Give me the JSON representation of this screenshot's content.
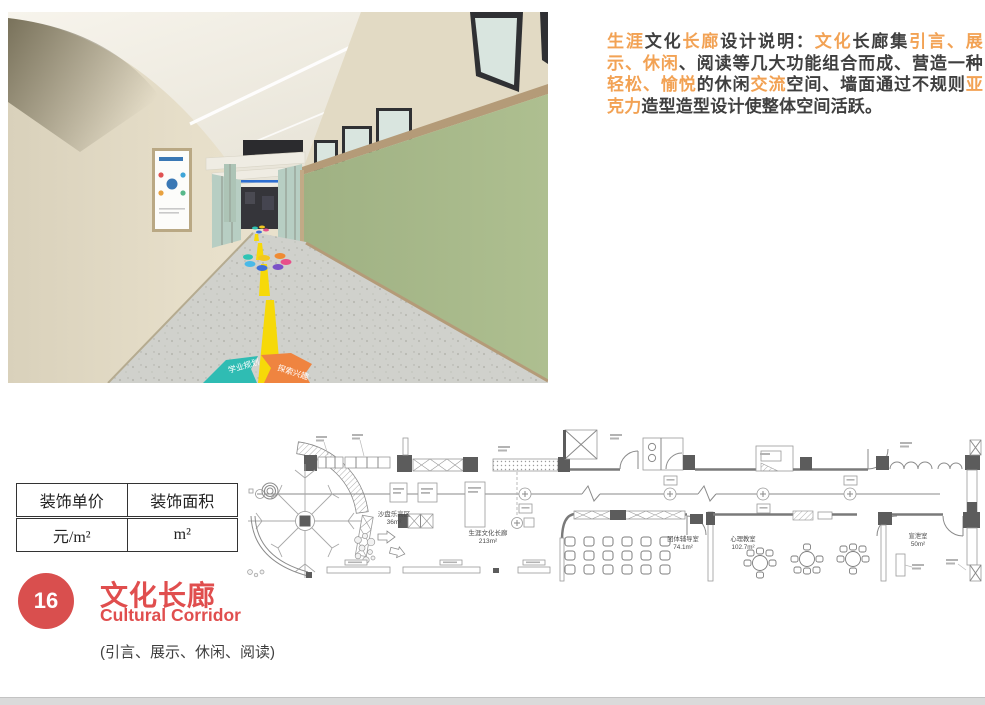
{
  "description": {
    "segments": [
      {
        "text": "生涯",
        "hl": true
      },
      {
        "text": "文化",
        "hl": false
      },
      {
        "text": "长廊",
        "hl": true
      },
      {
        "text": "设计说明：",
        "hl": false
      },
      {
        "text": "文化",
        "hl": true
      },
      {
        "text": "长廊集",
        "hl": false
      },
      {
        "text": "引言、展示、休闲",
        "hl": true
      },
      {
        "text": "、阅读等几大功能组合而成、营造一种",
        "hl": false
      },
      {
        "text": "轻松、愉悦",
        "hl": true
      },
      {
        "text": "的休闲",
        "hl": false
      },
      {
        "text": "交流",
        "hl": true
      },
      {
        "text": "空间、墙面通过不规则",
        "hl": false
      },
      {
        "text": "亚克力",
        "hl": true
      },
      {
        "text": "造型造型设计使整体空间活跃。",
        "hl": false
      }
    ]
  },
  "table": {
    "header_price": "装饰单价",
    "header_area": "装饰面积",
    "value_price": "元/m²",
    "value_area": "m²"
  },
  "section": {
    "number": "16",
    "title": "文化长廊",
    "subtitle": "Cultural Corridor",
    "features": "(引言、展示、休闲、阅读)",
    "accent_color": "#d94f4e"
  },
  "floor_plan": {
    "rooms": [
      {
        "name": "沙盘乐高区",
        "area": "36m²"
      },
      {
        "name": "生涯文化长廊",
        "area": "213m²"
      },
      {
        "name": "团体辅导室",
        "area": "74.1m²"
      },
      {
        "name": "心理教室",
        "area": "102.7m²"
      },
      {
        "name": "宣泄室",
        "area": "50m²"
      }
    ]
  },
  "photo": {
    "floor_label_1": "学业规划",
    "floor_label_2": "探索兴趣",
    "colors": {
      "left_wall": "#e9e1cd",
      "green_wall": "#a9ba8c",
      "trim": "#b49b78",
      "floor": "#d0d1cc",
      "path_yellow": "#f6d909"
    }
  }
}
